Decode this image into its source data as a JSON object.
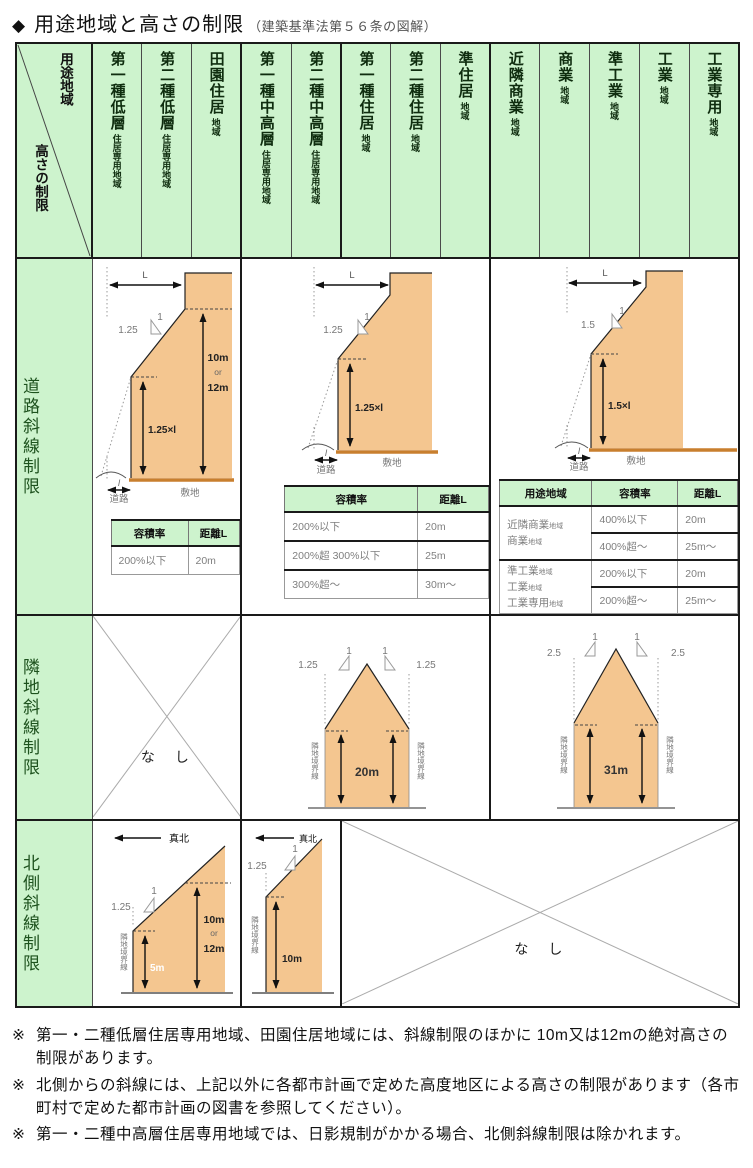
{
  "title": {
    "bullet": "◆",
    "main": "用途地域と高さの制限",
    "sub": "（建築基準法第５６条の図解）"
  },
  "corner": {
    "top": "用途地域",
    "bottom": "高さの制限"
  },
  "columns": [
    {
      "main": "第一種低層",
      "sub": "住居専用地域"
    },
    {
      "main": "第二種低層",
      "sub": "住居専用地域"
    },
    {
      "main": "田園住居",
      "sub": "地域"
    },
    {
      "main": "第一種中高層",
      "sub": "住居専用地域"
    },
    {
      "main": "第二種中高層",
      "sub": "住居専用地域"
    },
    {
      "main": "第一種住居",
      "sub": "地域"
    },
    {
      "main": "第二種住居",
      "sub": "地域"
    },
    {
      "main": "準住居",
      "sub": "地域"
    },
    {
      "main": "近隣商業",
      "sub": "地域"
    },
    {
      "main": "商業",
      "sub": "地域"
    },
    {
      "main": "準工業",
      "sub": "地域"
    },
    {
      "main": "工業",
      "sub": "地域"
    },
    {
      "main": "工業専用",
      "sub": "地域"
    }
  ],
  "row_labels": {
    "road": "道路斜線制限",
    "adjacent": "隣地斜線制限",
    "north": "北側斜線制限"
  },
  "none_label": "な　し",
  "road": {
    "a": {
      "L": "L",
      "one": "1",
      "ratio": "1.25",
      "setback": "1.25×l",
      "h_top": "10m",
      "h_or": "or",
      "h_bot": "12m",
      "road": "道路",
      "site": "敷地",
      "road_w": "l",
      "table": {
        "h1": "容積率",
        "h2": "距離L",
        "rows": [
          [
            "200%以下",
            "20m"
          ]
        ]
      }
    },
    "b": {
      "L": "L",
      "one": "1",
      "ratio": "1.25",
      "setback": "1.25×l",
      "road": "道路",
      "site": "敷地",
      "road_w": "l",
      "table": {
        "h1": "容積率",
        "h2": "距離L",
        "rows": [
          [
            "200%以下",
            "20m"
          ],
          [
            "200%超 300%以下",
            "25m"
          ],
          [
            "300%超〜",
            "30m〜"
          ]
        ]
      }
    },
    "c": {
      "L": "L",
      "one": "1",
      "ratio": "1.5",
      "setback": "1.5×l",
      "road": "道路",
      "site": "敷地",
      "road_w": "l",
      "table": {
        "h0": "用途地域",
        "h1": "容積率",
        "h2": "距離L",
        "g1": {
          "districts": [
            {
              "m": "近隣商業",
              "s": "地域"
            },
            {
              "m": "商業",
              "s": "地域"
            }
          ],
          "rows": [
            [
              "400%以下",
              "20m"
            ],
            [
              "400%超〜",
              "25m〜"
            ]
          ]
        },
        "g2": {
          "districts": [
            {
              "m": "準工業",
              "s": "地域"
            },
            {
              "m": "工業",
              "s": "地域"
            },
            {
              "m": "工業専用",
              "s": "地域"
            }
          ],
          "rows": [
            [
              "200%以下",
              "20m"
            ],
            [
              "200%超〜",
              "25m〜"
            ]
          ]
        }
      }
    }
  },
  "adjacent": {
    "b": {
      "one": "1",
      "ratio": "1.25",
      "height": "20m",
      "boundary": "隣地境界線"
    },
    "c": {
      "one": "1",
      "ratio": "2.5",
      "height": "31m",
      "boundary": "隣地境界線"
    }
  },
  "north": {
    "truenorth": "真北",
    "a": {
      "one": "1",
      "ratio": "1.25",
      "h_small": "5m",
      "h_top": "10m",
      "h_or": "or",
      "h_bot": "12m",
      "boundary": "隣地境界線"
    },
    "b": {
      "one": "1",
      "ratio": "1.25",
      "height": "10m",
      "boundary": "隣地境界線"
    }
  },
  "notes": [
    {
      "marker": "※",
      "text": "第一・二種低層住居専用地域、田園住居地域には、斜線制限のほかに 10m又は12mの絶対高さの制限があります。"
    },
    {
      "marker": "※",
      "text": "北側からの斜線には、上記以外に各都市計画で定めた高度地区による高さの制限があります（各市町村で定めた都市計画の図書を参照してください）。"
    },
    {
      "marker": "※",
      "text": "第一・二種中高層住居専用地域では、日影規制がかかる場合、北側斜線制限は除かれます。"
    }
  ],
  "colors": {
    "header_green": "#cdf3cd",
    "building_orange": "#f4c690",
    "ground_orange": "#c87f2e"
  }
}
